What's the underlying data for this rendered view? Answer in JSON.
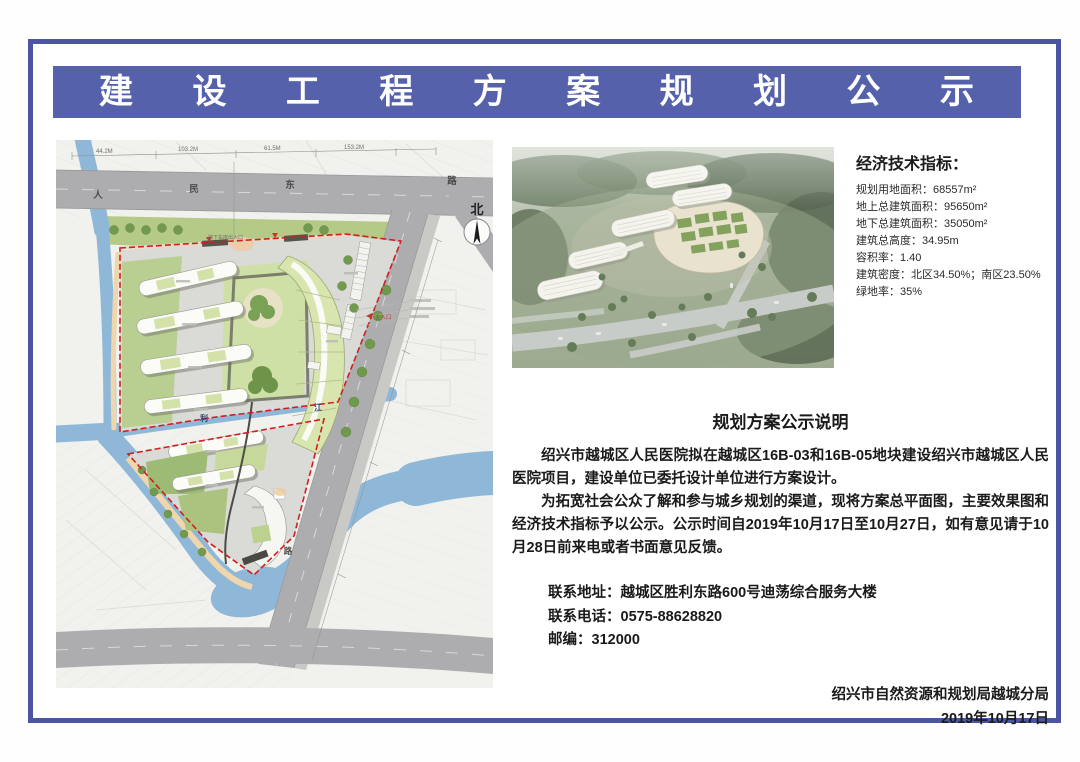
{
  "banner": {
    "title": "建 设 工 程 方 案 规 划 公 示"
  },
  "indicators": {
    "title": "经济技术指标：",
    "items": [
      "规划用地面积：68557m²",
      "地上总建筑面积：95650m²",
      "地下总建筑面积：35050m²",
      "建筑总高度：34.95m",
      "容积率：1.40",
      "建筑密度：北区34.50%；南区23.50%",
      "绿地率：35%"
    ]
  },
  "notice": {
    "title": "规划方案公示说明",
    "paragraphs": [
      "绍兴市越城区人民医院拟在越城区16B-03和16B-05地块建设绍兴市越城区人民医院项目，建设单位已委托设计单位进行方案设计。",
      "为拓宽社会公众了解和参与城乡规划的渠道，现将方案总平面图，主要效果图和经济技术指标予以公示。公示时间自2019年10月17日至10月27日，如有意见请于10月28日前来电或者书面意见反馈。"
    ],
    "contact": {
      "address": "联系地址：越城区胜利东路600号迪荡综合服务大楼",
      "phone": "联系电话：0575-88628820",
      "postcode": "邮编：312000"
    },
    "signature": {
      "org": "绍兴市自然资源和规划局越城分局",
      "date": "2019年10月17日"
    }
  },
  "siteplan": {
    "north_label": "北",
    "road_labels": {
      "r1": "人",
      "r2": "民",
      "r3": "东",
      "r4": "路",
      "diag": "路"
    },
    "river_labels": {
      "a": "利",
      "b": "江"
    },
    "annotations": {
      "entrance": "主入口",
      "garage": "地下车库出入口"
    },
    "dims": {
      "d1": "44.2M",
      "d2": "103.2M",
      "d3": "61.5M",
      "d4": "153.2M"
    }
  },
  "colors": {
    "banner_bg": "#5561ab",
    "frame": "#4b55a3",
    "boundary_red": "#cf2020",
    "water": "#8fb8d8",
    "road_gray": "#adadaf",
    "green": "#b5ca87"
  }
}
